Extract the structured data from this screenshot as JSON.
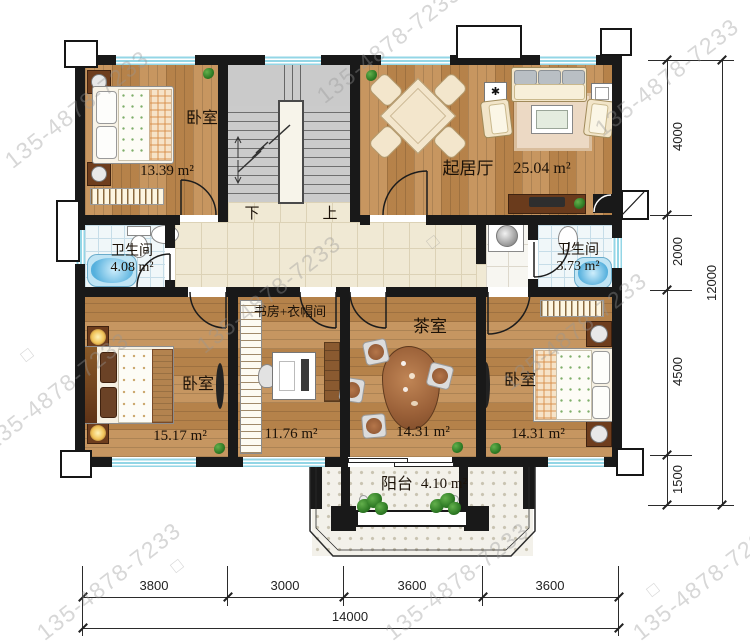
{
  "watermark": {
    "text": "135-4878-7233",
    "square": "□"
  },
  "rooms": {
    "bedroom_tl": {
      "name": "卧室",
      "area": "13.39 m²"
    },
    "living": {
      "name": "起居厅",
      "area": "25.04 m²"
    },
    "bath_left": {
      "name": "卫生间",
      "area": "4.08 m²"
    },
    "bath_right": {
      "name": "卫生间",
      "area": "3.73 m²"
    },
    "bedroom_bl": {
      "name": "卧室",
      "area": "15.17 m²"
    },
    "study": {
      "name": "书房+衣帽间",
      "area": "11.76 m²"
    },
    "tea": {
      "name": "茶室",
      "area": "14.31 m²"
    },
    "bedroom_br": {
      "name": "卧室",
      "area": "14.31 m²"
    },
    "balcony": {
      "name": "阳台",
      "area": "4.10 m²"
    }
  },
  "stairs": {
    "down": "下",
    "up": "上"
  },
  "dimensions": {
    "right": [
      "4000",
      "2000",
      "4500",
      "1500"
    ],
    "right_total": "12000",
    "bottom": [
      "3800",
      "3000",
      "3600",
      "3600"
    ],
    "bottom_total": "14000"
  },
  "colors": {
    "wall": "#191919",
    "wood": "#c18a4e",
    "hall_tile": "#f0e9d4",
    "bath_tile": "#f0f7f9",
    "stair": "#cacaca",
    "window": "#93d6e6",
    "tub": "#5ab4e0"
  }
}
